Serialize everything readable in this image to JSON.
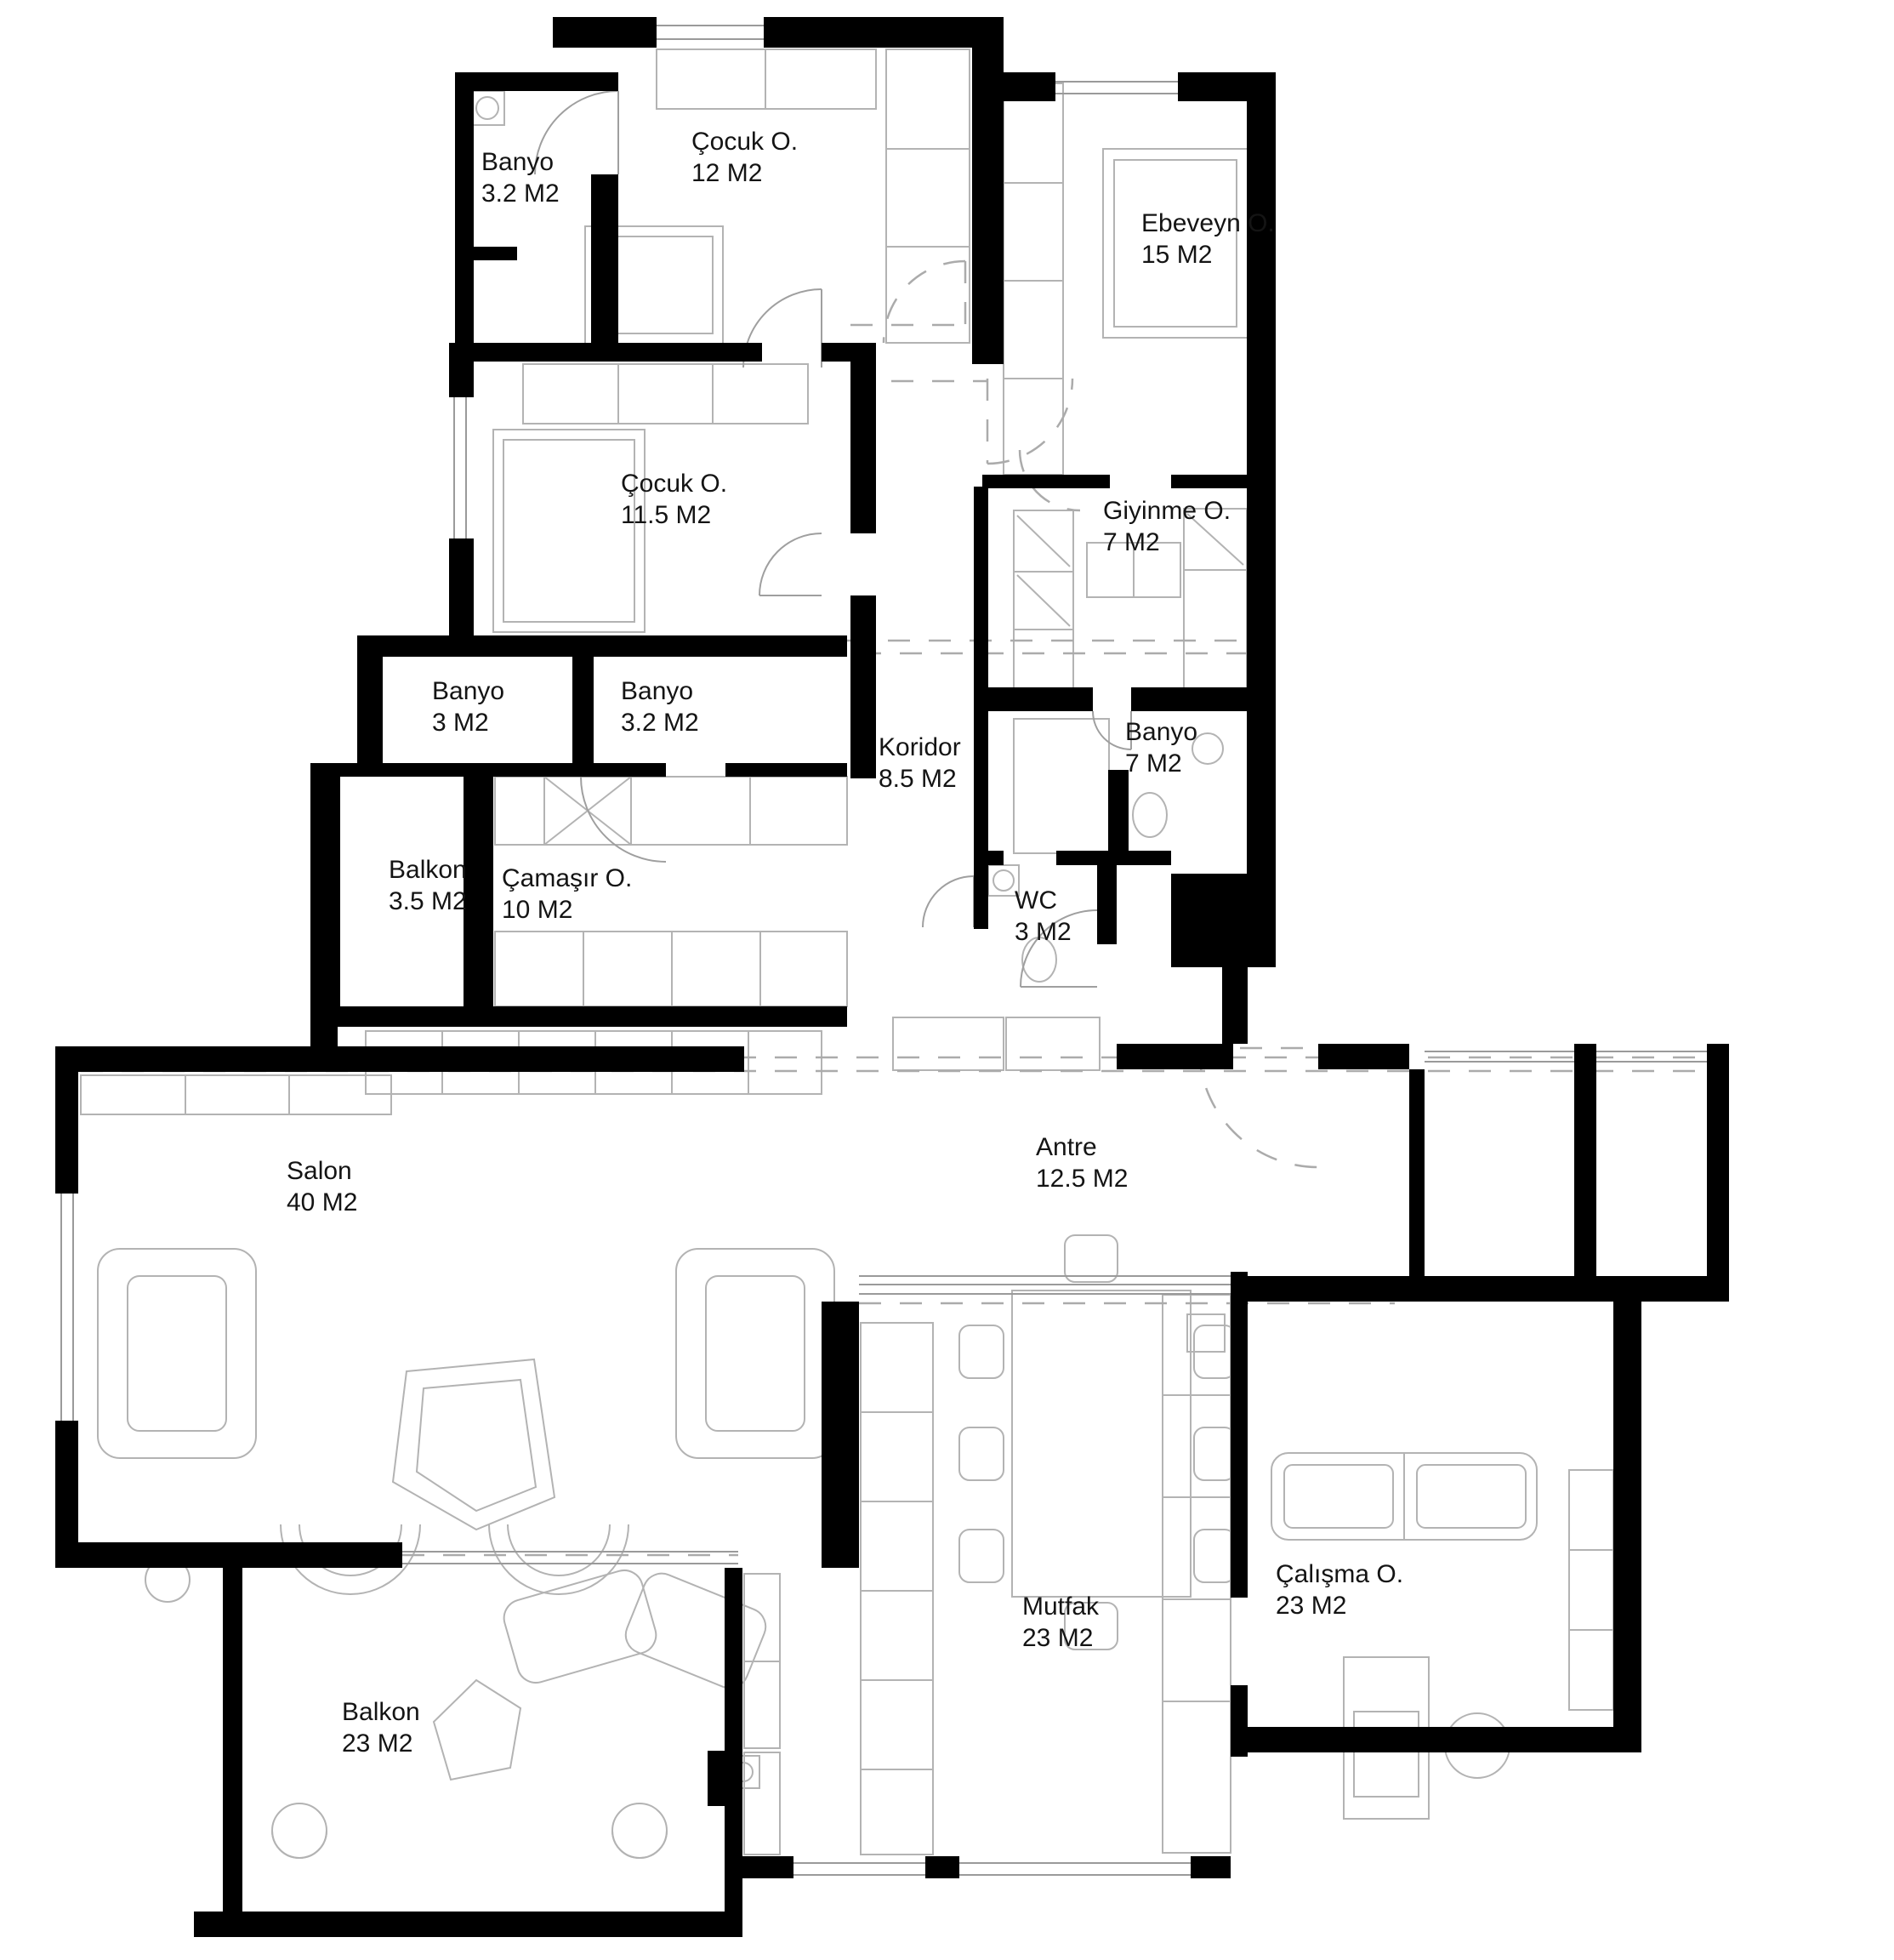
{
  "plan_title": "Apartment Floor Plan",
  "units_suffix": "M2",
  "rooms": [
    {
      "id": "banyo-top-left",
      "name": "Banyo",
      "area": "3.2 M2"
    },
    {
      "id": "cocuk-odasi-1",
      "name": "Çocuk O.",
      "area": "12 M2"
    },
    {
      "id": "ebeveyn-odasi",
      "name": "Ebeveyn O.",
      "area": "15 M2"
    },
    {
      "id": "cocuk-odasi-2",
      "name": "Çocuk O.",
      "area": "11.5 M2"
    },
    {
      "id": "giyinme-odasi",
      "name": "Giyinme O.",
      "area": "7 M2"
    },
    {
      "id": "banyo-3",
      "name": "Banyo",
      "area": "3 M2"
    },
    {
      "id": "banyo-32",
      "name": "Banyo",
      "area": "3.2 M2"
    },
    {
      "id": "koridor",
      "name": "Koridor",
      "area": "8.5 M2"
    },
    {
      "id": "banyo-7",
      "name": "Banyo",
      "area": "7 M2"
    },
    {
      "id": "balkon-kucuk",
      "name": "Balkon",
      "area": "3.5 M2"
    },
    {
      "id": "camasir-odasi",
      "name": "Çamaşır O.",
      "area": "10 M2"
    },
    {
      "id": "wc",
      "name": "WC",
      "area": "3 M2"
    },
    {
      "id": "antre",
      "name": "Antre",
      "area": "12.5 M2"
    },
    {
      "id": "salon",
      "name": "Salon",
      "area": "40 M2"
    },
    {
      "id": "mutfak",
      "name": "Mutfak",
      "area": "23 M2"
    },
    {
      "id": "calisma-odasi",
      "name": "Çalışma O.",
      "area": "23 M2"
    },
    {
      "id": "balkon-buyuk",
      "name": "Balkon",
      "area": "23 M2"
    }
  ],
  "colors": {
    "wall": "#000000",
    "furniture_line": "#b3b3b3",
    "window_line": "#9a9a9a",
    "text": "#141414",
    "background": "#ffffff"
  }
}
